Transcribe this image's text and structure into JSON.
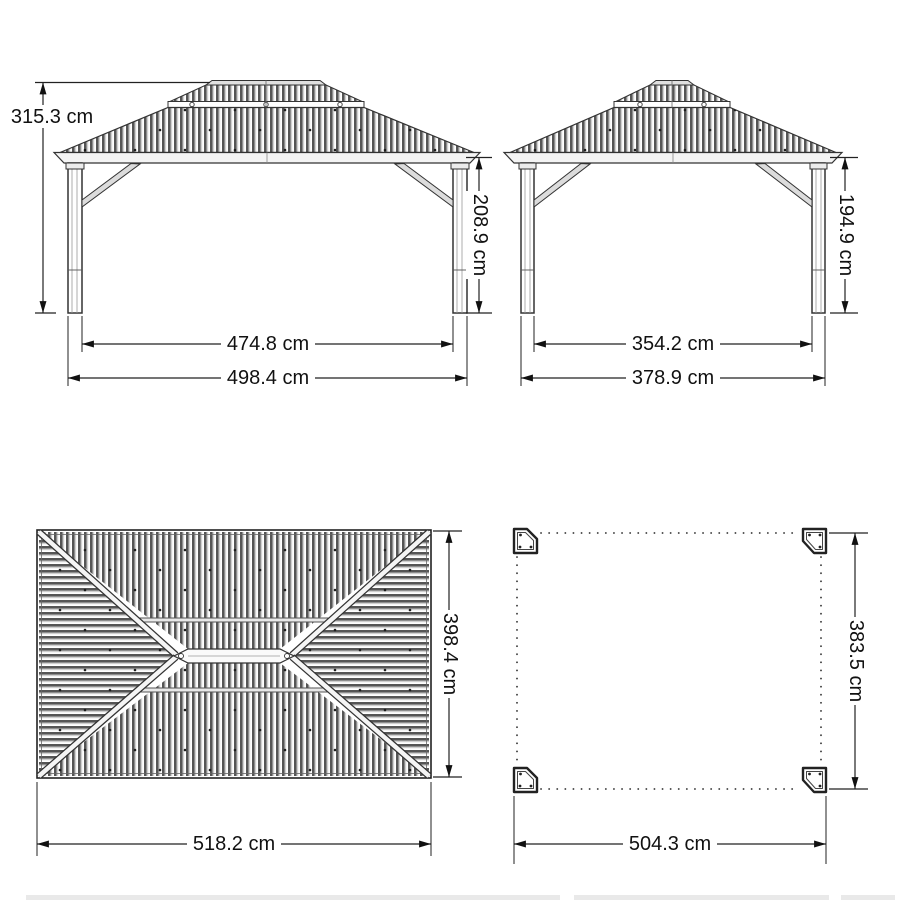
{
  "drawing": {
    "title": "gazebo-dimension-drawing",
    "unit": "cm",
    "front_elevation": {
      "overall_height": "315.3 cm",
      "clearance_height": "208.9 cm",
      "inner_post_width": "474.8 cm",
      "outer_post_width": "498.4 cm"
    },
    "side_elevation": {
      "clearance_height": "194.9 cm",
      "inner_post_depth": "354.2 cm",
      "outer_post_depth": "378.9 cm"
    },
    "roof_plan": {
      "roof_depth": "398.4 cm",
      "roof_width": "518.2 cm"
    },
    "base_plan": {
      "base_depth": "383.5 cm",
      "base_width": "504.3 cm"
    },
    "colors": {
      "ink": "#1a1a1a",
      "corrugation_dark": "#555555",
      "corrugation_light": "#cfcfcf",
      "panel_fill": "#f4f4f4",
      "background": "#ffffff"
    }
  }
}
